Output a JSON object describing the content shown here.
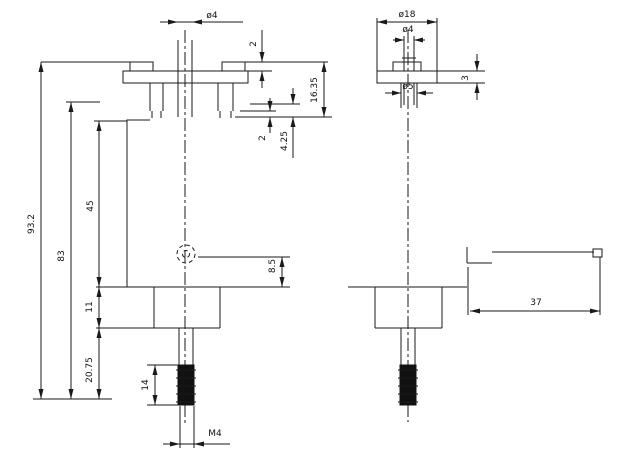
{
  "drawing_type": "mechanical-part-dimension-drawing",
  "colors": {
    "line": "#1a1a1a",
    "background": "#ffffff"
  },
  "dims": {
    "front_top_diameter": "ø4",
    "front_cap_height": "2",
    "front_total_height": "93.2",
    "front_height_to_bottom": "83",
    "front_body_height": "45",
    "front_base_height": "11",
    "front_lower_height": "20.75",
    "front_head_depth": "16.35",
    "front_pin_length": "4.25",
    "front_pin_tip": "2",
    "front_hole_offset": "8.5",
    "front_thread_length": "14",
    "front_thread_spec": "M4",
    "side_flange_diameter": "ø18",
    "side_top_diameter": "ø4",
    "side_flange_thickness": "3",
    "side_stem_diameter": "ø5",
    "lever_length": "37"
  }
}
